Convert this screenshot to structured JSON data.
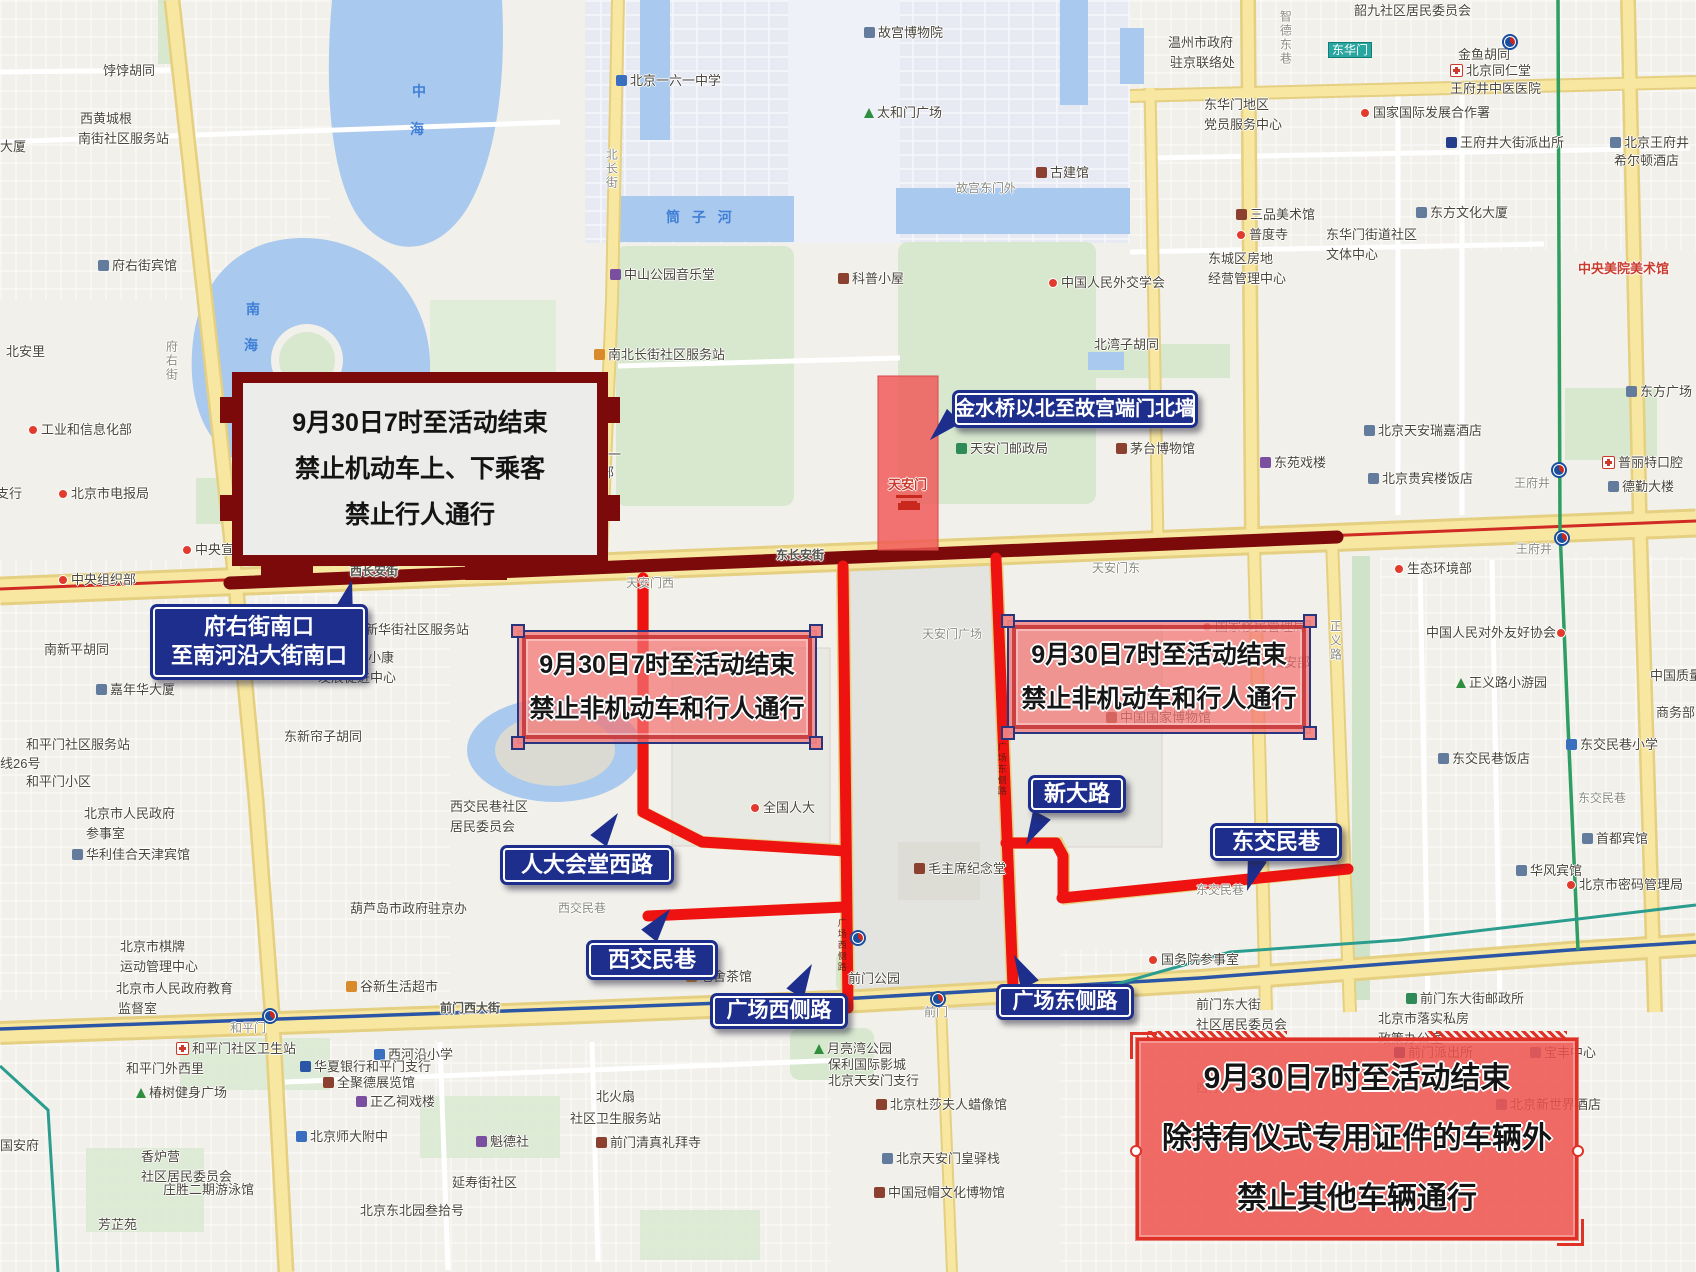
{
  "colors": {
    "closed-road": "#ee1310",
    "changan-closed-road": "#7c0a0a",
    "callout-bg": "#1d2e8c",
    "pink-zone-fill": "rgba(242,115,115,0.72)",
    "tiananmen-zone-fill": "rgba(240,85,85,0.82)",
    "southeast-zone-fill": "rgba(238,82,76,0.85)",
    "major-road": "#f8e7a1",
    "water": "#a9c9ee",
    "park-green": "#d7e8cf"
  },
  "overlays": {
    "banner": {
      "lines": [
        "9月30日7时至活动结束",
        "禁止机动车上、下乘客",
        "禁止行人通行"
      ]
    },
    "square_west": {
      "lines": [
        "9月30日7时至活动结束",
        "禁止非机动车和行人通行"
      ]
    },
    "square_east": {
      "lines": [
        "9月30日7时至活动结束",
        "禁止非机动车和行人通行"
      ]
    },
    "southeast": {
      "lines": [
        "9月30日7时至活动结束",
        "除持有仪式专用证件的车辆外",
        "禁止其他车辆通行"
      ]
    },
    "closed_road_names": [
      "人大会堂西路",
      "西交民巷",
      "广场西侧路",
      "广场东侧路",
      "新大路",
      "东交民巷",
      "西长安街",
      "东长安街"
    ]
  },
  "callouts": [
    {
      "id": "fuyoujie-nankou",
      "lines": [
        "府右街南口",
        "至南河沿大街南口"
      ],
      "x": 150,
      "y": 604,
      "w": 218,
      "h": 76,
      "fs": 22,
      "p": {
        "x": 352,
        "y": 580,
        "r": 15
      }
    },
    {
      "id": "jinshuiqiao",
      "lines": [
        "金水桥以北至故宫端门北墙"
      ],
      "x": 952,
      "y": 390,
      "w": 246,
      "h": 38,
      "fs": 20,
      "p": {
        "x": 930,
        "y": 440,
        "r": 225
      }
    },
    {
      "id": "rendahuitang-xilu",
      "lines": [
        "人大会堂西路"
      ],
      "x": 500,
      "y": 845,
      "w": 174,
      "h": 40,
      "fs": 22,
      "p": {
        "x": 618,
        "y": 813,
        "r": 35
      }
    },
    {
      "id": "xijiaominxiang",
      "lines": [
        "西交民巷"
      ],
      "x": 586,
      "y": 940,
      "w": 132,
      "h": 40,
      "fs": 22,
      "p": {
        "x": 670,
        "y": 909,
        "r": 38
      }
    },
    {
      "id": "guangchang-xicelu",
      "lines": [
        "广场西侧路"
      ],
      "x": 710,
      "y": 993,
      "w": 138,
      "h": 36,
      "fs": 21,
      "p": {
        "x": 812,
        "y": 964,
        "r": 30
      }
    },
    {
      "id": "guangchang-dongcelu",
      "lines": [
        "广场东侧路"
      ],
      "x": 996,
      "y": 984,
      "w": 138,
      "h": 36,
      "fs": 21,
      "p": {
        "x": 1014,
        "y": 955,
        "r": -28
      }
    },
    {
      "id": "xindalu",
      "lines": [
        "新大路"
      ],
      "x": 1028,
      "y": 775,
      "w": 98,
      "h": 38,
      "fs": 22,
      "p": {
        "x": 1026,
        "y": 845,
        "r": 208
      }
    },
    {
      "id": "dongjiaominxiang",
      "lines": [
        "东交民巷"
      ],
      "x": 1210,
      "y": 823,
      "w": 132,
      "h": 38,
      "fs": 22,
      "p": {
        "x": 1247,
        "y": 891,
        "r": 198
      }
    }
  ],
  "map": {
    "metro_stations": [
      [
        270,
        1016
      ],
      [
        858,
        938
      ],
      [
        938,
        999
      ],
      [
        1510,
        42
      ],
      [
        1559,
        470
      ],
      [
        1562,
        538
      ]
    ],
    "labels": [
      {
        "t": "饽饽胡同",
        "x": 103,
        "y": 63
      },
      {
        "t": "西黄城根",
        "x": 80,
        "y": 111
      },
      {
        "t": "南街社区服务站",
        "x": 78,
        "y": 131
      },
      {
        "t": "大厦",
        "x": 0,
        "y": 139
      },
      {
        "t": "府右街宾馆",
        "x": 98,
        "y": 258,
        "i": "bld"
      },
      {
        "t": "北安里",
        "x": 6,
        "y": 344
      },
      {
        "t": "工业和信息化部",
        "x": 28,
        "y": 422,
        "i": "dot"
      },
      {
        "t": "西单支行",
        "x": -30,
        "y": 486
      },
      {
        "t": "北京市电报局",
        "x": 58,
        "y": 486,
        "i": "dot"
      },
      {
        "t": "中央宣传部",
        "x": 182,
        "y": 542,
        "i": "dot"
      },
      {
        "t": "中央组织部",
        "x": 58,
        "y": 572,
        "i": "dot"
      },
      {
        "t": "北新华街社区服务站",
        "x": 352,
        "y": 622
      },
      {
        "t": "南新平胡同",
        "x": 44,
        "y": 642
      },
      {
        "t": "嘉年华大厦",
        "x": 96,
        "y": 682,
        "i": "bld"
      },
      {
        "t": "中国城乡小康",
        "x": 316,
        "y": 650
      },
      {
        "t": "发展促进中心",
        "x": 318,
        "y": 670
      },
      {
        "t": "和平门社区服务站",
        "x": 26,
        "y": 737
      },
      {
        "t": "线26号",
        "x": 0,
        "y": 756
      },
      {
        "t": "和平门小区",
        "x": 26,
        "y": 774
      },
      {
        "t": "东新帘子胡同",
        "x": 284,
        "y": 729
      },
      {
        "t": "北京市人民政府",
        "x": 84,
        "y": 806
      },
      {
        "t": "参事室",
        "x": 86,
        "y": 826
      },
      {
        "t": "华利佳合天津宾馆",
        "x": 72,
        "y": 847,
        "i": "bld"
      },
      {
        "t": "西交民巷社区",
        "x": 450,
        "y": 799
      },
      {
        "t": "居民委员会",
        "x": 450,
        "y": 819
      },
      {
        "t": "全国人大",
        "x": 750,
        "y": 800,
        "i": "dot"
      },
      {
        "t": "葫芦岛市政府驻京办",
        "x": 350,
        "y": 901
      },
      {
        "t": "西交民巷",
        "x": 558,
        "y": 901,
        "c": "street"
      },
      {
        "t": "北京市棋牌",
        "x": 120,
        "y": 939
      },
      {
        "t": "运动管理中心",
        "x": 120,
        "y": 959
      },
      {
        "t": "北京市人民政府教育",
        "x": 116,
        "y": 981
      },
      {
        "t": "监督室",
        "x": 118,
        "y": 1001
      },
      {
        "t": "谷新生活超市",
        "x": 346,
        "y": 979,
        "i": "shop"
      },
      {
        "t": "前门西大街",
        "x": 440,
        "y": 1001,
        "c": "onroad"
      },
      {
        "t": "和平门",
        "x": 230,
        "y": 1021,
        "c": "street"
      },
      {
        "t": "和平门社区卫生站",
        "x": 176,
        "y": 1041,
        "i": "hosp"
      },
      {
        "t": "西河沿小学",
        "x": 374,
        "y": 1047,
        "i": "school"
      },
      {
        "t": "华夏银行和平门支行",
        "x": 300,
        "y": 1059,
        "i": "bank"
      },
      {
        "t": "全聚德展览馆",
        "x": 323,
        "y": 1075,
        "i": "museum"
      },
      {
        "t": "和平门外西里",
        "x": 126,
        "y": 1061
      },
      {
        "t": "椿树健身广场",
        "x": 136,
        "y": 1085,
        "i": "tree"
      },
      {
        "t": "正乙祠戏楼",
        "x": 356,
        "y": 1094,
        "i": "theater"
      },
      {
        "t": "北京师大附中",
        "x": 296,
        "y": 1129,
        "i": "school"
      },
      {
        "t": "魁德社",
        "x": 476,
        "y": 1134,
        "i": "theater"
      },
      {
        "t": "国安府",
        "x": 0,
        "y": 1138
      },
      {
        "t": "香炉营",
        "x": 141,
        "y": 1149
      },
      {
        "t": "社区居民委员会",
        "x": 141,
        "y": 1169
      },
      {
        "t": "庄胜二期游泳馆",
        "x": 163,
        "y": 1182
      },
      {
        "t": "延寿街社区",
        "x": 452,
        "y": 1175
      },
      {
        "t": "北京东北园叁拾号",
        "x": 360,
        "y": 1203
      },
      {
        "t": "芳芷苑",
        "x": 98,
        "y": 1217
      },
      {
        "t": "北火扇",
        "x": 596,
        "y": 1089
      },
      {
        "t": "社区卫生服务站",
        "x": 570,
        "y": 1111
      },
      {
        "t": "前门清真礼拜寺",
        "x": 596,
        "y": 1135,
        "i": "museum"
      },
      {
        "t": "老舍茶馆",
        "x": 686,
        "y": 969,
        "i": "shop"
      },
      {
        "t": "前门公园",
        "x": 848,
        "y": 971
      },
      {
        "t": "月亮湾公园",
        "x": 814,
        "y": 1041,
        "i": "tree"
      },
      {
        "t": "保利国际影城",
        "x": 828,
        "y": 1057
      },
      {
        "t": "北京天安门支行",
        "x": 828,
        "y": 1073
      },
      {
        "t": "前门",
        "x": 924,
        "y": 1005,
        "c": "street"
      },
      {
        "t": "北京杜莎夫人蜡像馆",
        "x": 876,
        "y": 1097,
        "i": "museum"
      },
      {
        "t": "北京天安门皇驿栈",
        "x": 882,
        "y": 1151,
        "i": "bld"
      },
      {
        "t": "中国冠帽文化博物馆",
        "x": 874,
        "y": 1185,
        "i": "museum"
      },
      {
        "t": "国务院参事室",
        "x": 1148,
        "y": 952,
        "i": "dot"
      },
      {
        "t": "前门东大街",
        "x": 1196,
        "y": 997
      },
      {
        "t": "社区居民委员会",
        "x": 1196,
        "y": 1017
      },
      {
        "t": "前门东大街邮政所",
        "x": 1406,
        "y": 991,
        "i": "post"
      },
      {
        "t": "北京市落实私房",
        "x": 1378,
        "y": 1011
      },
      {
        "t": "政策办公室",
        "x": 1378,
        "y": 1031
      },
      {
        "t": "前门派出所",
        "x": 1394,
        "y": 1045,
        "i": "police"
      },
      {
        "t": "宝丰中心",
        "x": 1530,
        "y": 1045,
        "i": "bld"
      },
      {
        "t": "西打磨厂街",
        "x": 1196,
        "y": 1081,
        "c": "street"
      },
      {
        "t": "北京新世界酒店",
        "x": 1496,
        "y": 1097,
        "i": "bld"
      },
      {
        "t": "韶九社区居民委员会",
        "x": 1354,
        "y": 3
      },
      {
        "t": "东华门",
        "x": 1328,
        "y": 42,
        "c": "teal"
      },
      {
        "t": "金鱼胡同",
        "x": 1458,
        "y": 47
      },
      {
        "t": "北京同仁堂",
        "x": 1450,
        "y": 63,
        "i": "hosp"
      },
      {
        "t": "王府井中医医院",
        "x": 1450,
        "y": 81
      },
      {
        "t": "温州市政府",
        "x": 1168,
        "y": 35
      },
      {
        "t": "驻京联络处",
        "x": 1170,
        "y": 55
      },
      {
        "t": "智德东巷",
        "x": 1278,
        "y": 10,
        "v": true,
        "c": "street"
      },
      {
        "t": "国家国际发展合作署",
        "x": 1360,
        "y": 105,
        "i": "dot"
      },
      {
        "t": "东华门地区",
        "x": 1204,
        "y": 97
      },
      {
        "t": "党员服务中心",
        "x": 1204,
        "y": 117
      },
      {
        "t": "王府井大街派出所",
        "x": 1446,
        "y": 135,
        "i": "police"
      },
      {
        "t": "北京王府井",
        "x": 1610,
        "y": 135,
        "i": "bld"
      },
      {
        "t": "希尔顿酒店",
        "x": 1614,
        "y": 153
      },
      {
        "t": "三品美术馆",
        "x": 1236,
        "y": 207,
        "i": "museum"
      },
      {
        "t": "普度寺",
        "x": 1236,
        "y": 227,
        "i": "dot"
      },
      {
        "t": "东方文化大厦",
        "x": 1416,
        "y": 205,
        "i": "bld"
      },
      {
        "t": "东华门街道社区",
        "x": 1326,
        "y": 227
      },
      {
        "t": "文体中心",
        "x": 1326,
        "y": 247
      },
      {
        "t": "东城区房地",
        "x": 1208,
        "y": 251
      },
      {
        "t": "经营管理中心",
        "x": 1208,
        "y": 271
      },
      {
        "t": "中央美院美术馆",
        "x": 1578,
        "y": 261,
        "c": "red"
      },
      {
        "t": "东方广场",
        "x": 1626,
        "y": 384,
        "i": "bld"
      },
      {
        "t": "北湾子胡同",
        "x": 1094,
        "y": 337
      },
      {
        "t": "北京天安瑞嘉酒店",
        "x": 1364,
        "y": 423,
        "i": "bld"
      },
      {
        "t": "茅台博物馆",
        "x": 1116,
        "y": 441,
        "i": "museum"
      },
      {
        "t": "东苑戏楼",
        "x": 1260,
        "y": 455,
        "i": "theater"
      },
      {
        "t": "北京贵宾楼饭店",
        "x": 1368,
        "y": 471,
        "i": "bld"
      },
      {
        "t": "王府井",
        "x": 1514,
        "y": 476,
        "c": "street"
      },
      {
        "t": "普丽特口腔",
        "x": 1602,
        "y": 455,
        "i": "hosp"
      },
      {
        "t": "德勤大楼",
        "x": 1608,
        "y": 479,
        "i": "bld"
      },
      {
        "t": "王府井",
        "x": 1516,
        "y": 542,
        "c": "street"
      },
      {
        "t": "生态环境部",
        "x": 1394,
        "y": 561,
        "i": "dot"
      },
      {
        "t": "国家移民管理局",
        "x": 1202,
        "y": 619,
        "i": "dot"
      },
      {
        "t": "公安部",
        "x": 1258,
        "y": 655,
        "i": "dot"
      },
      {
        "t": "中国人民对外友好协会",
        "x": 1426,
        "y": 625,
        "i": "dot",
        "ir": true
      },
      {
        "t": "中国质量大厦",
        "x": 1650,
        "y": 668
      },
      {
        "t": "商务部",
        "x": 1656,
        "y": 705
      },
      {
        "t": "正义路小游园",
        "x": 1456,
        "y": 675,
        "i": "tree"
      },
      {
        "t": "正义路",
        "x": 1328,
        "y": 620,
        "v": true,
        "c": "street"
      },
      {
        "t": "中国国家博物馆",
        "x": 1106,
        "y": 710,
        "i": "museum"
      },
      {
        "t": "东交民巷小学",
        "x": 1566,
        "y": 737,
        "i": "school"
      },
      {
        "t": "东交民巷饭店",
        "x": 1438,
        "y": 751,
        "i": "bld"
      },
      {
        "t": "东交民巷",
        "x": 1578,
        "y": 791,
        "c": "street"
      },
      {
        "t": "首都宾馆",
        "x": 1582,
        "y": 831,
        "i": "bld"
      },
      {
        "t": "华风宾馆",
        "x": 1516,
        "y": 863,
        "i": "bld"
      },
      {
        "t": "北京市密码管理局",
        "x": 1566,
        "y": 877,
        "i": "dot"
      },
      {
        "t": "东交民巷",
        "x": 1196,
        "y": 883,
        "c": "street"
      },
      {
        "t": "天安门广场",
        "x": 922,
        "y": 627,
        "c": "street"
      },
      {
        "t": "毛主席纪念堂",
        "x": 914,
        "y": 861,
        "i": "museum"
      },
      {
        "t": "天安门西",
        "x": 626,
        "y": 576,
        "c": "street"
      },
      {
        "t": "天安门东",
        "x": 1092,
        "y": 561,
        "c": "street"
      },
      {
        "t": "西长安街",
        "x": 350,
        "y": 564,
        "c": "onroad"
      },
      {
        "t": "东长安街",
        "x": 776,
        "y": 548,
        "c": "onroad"
      },
      {
        "t": "天安门邮政局",
        "x": 956,
        "y": 441,
        "i": "post"
      },
      {
        "t": "天安门",
        "x": 888,
        "y": 477,
        "c": "red"
      },
      {
        "t": "",
        "x": 896,
        "y": 495,
        "i": "gate"
      },
      {
        "t": "故宫博物院",
        "x": 864,
        "y": 25,
        "i": "bld"
      },
      {
        "t": "太和门广场",
        "x": 864,
        "y": 105,
        "i": "tree"
      },
      {
        "t": "故宫东门外",
        "x": 956,
        "y": 181,
        "c": "street"
      },
      {
        "t": "古建馆",
        "x": 1036,
        "y": 165,
        "i": "museum"
      },
      {
        "t": "北京一六一中学",
        "x": 616,
        "y": 73,
        "i": "school"
      },
      {
        "t": "中山公园音乐堂",
        "x": 610,
        "y": 267,
        "i": "theater"
      },
      {
        "t": "科普小屋",
        "x": 838,
        "y": 271,
        "i": "museum"
      },
      {
        "t": "中国人民外交学会",
        "x": 1048,
        "y": 275,
        "i": "dot"
      },
      {
        "t": "南北长街社区服务站",
        "x": 594,
        "y": 347,
        "i": "shop"
      },
      {
        "t": "北京一六一",
        "x": 556,
        "y": 447
      },
      {
        "t": "学高中部",
        "x": 562,
        "y": 465
      },
      {
        "t": "筒 子 河",
        "x": 666,
        "y": 209,
        "c": "water"
      },
      {
        "t": "中",
        "x": 412,
        "y": 83,
        "c": "water"
      },
      {
        "t": "海",
        "x": 410,
        "y": 121,
        "c": "water"
      },
      {
        "t": "南",
        "x": 246,
        "y": 301,
        "c": "water"
      },
      {
        "t": "海",
        "x": 244,
        "y": 337,
        "c": "water"
      },
      {
        "t": "府右街",
        "x": 164,
        "y": 340,
        "v": true,
        "c": "street"
      },
      {
        "t": "北长街",
        "x": 604,
        "y": 148,
        "v": true,
        "c": "street"
      },
      {
        "t": "广场西侧路",
        "x": 836,
        "y": 918,
        "v": true,
        "c": "tiny"
      },
      {
        "t": "广场东侧路",
        "x": 996,
        "y": 742,
        "v": true,
        "c": "tiny"
      }
    ]
  }
}
